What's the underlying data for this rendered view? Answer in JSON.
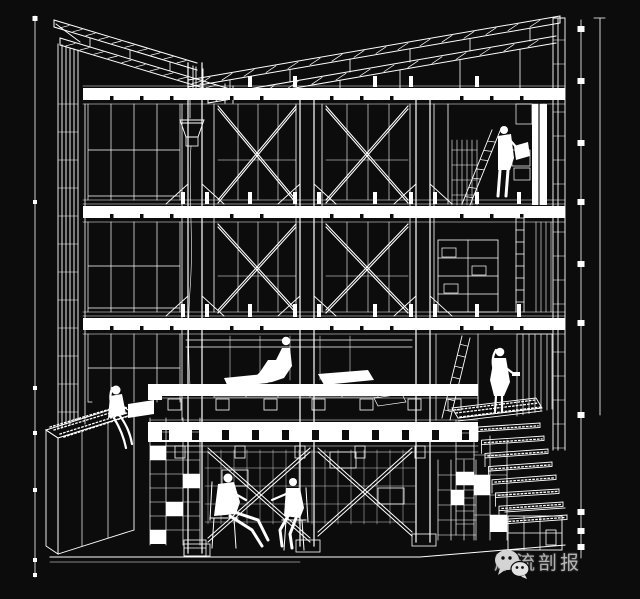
{
  "canvas": {
    "width": 640,
    "height": 599,
    "background_color": "#0c0c0c",
    "line_color": "#ffffff"
  },
  "drawing": {
    "kind": "black-and-white architectural cutaway perspective section",
    "subject": "Three-storey timber-framed building section with mono-pitch truss roof, cross-braced window bays, rain chain with funnel, central sitting platform, sunken meeting space, planter box and exterior stepped stair",
    "storeys": 3,
    "figures": [
      "person-reading-on-upper-floor",
      "person-sitting-on-platform",
      "person-sitting-on-planter-edge",
      "person-standing-at-stair-landing",
      "person-seated-in-armchair-basement",
      "person-seated-on-chair-basement"
    ]
  },
  "watermark": {
    "icon": "wechat-icon",
    "text": "犀流剖报",
    "text_color": "rgba(255,255,255,0.62)",
    "icon_color": "#d4d4d4"
  }
}
